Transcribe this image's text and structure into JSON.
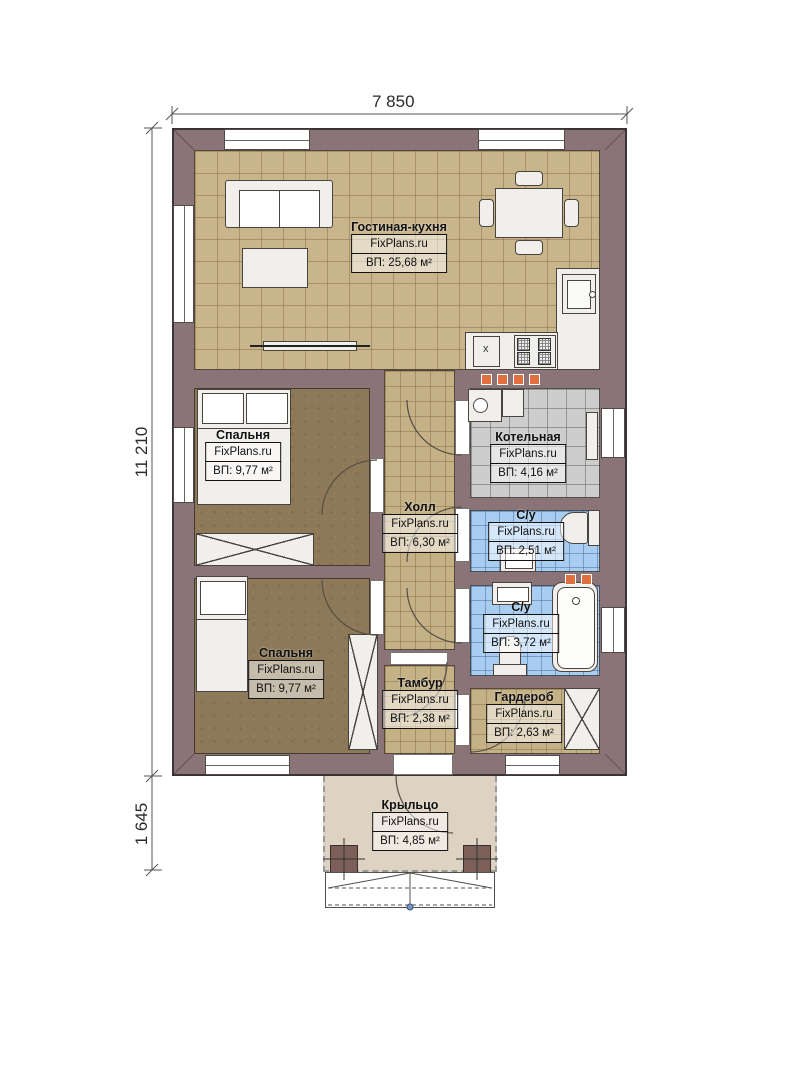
{
  "watermark": "FixPlans.ru",
  "dimensions": {
    "width_top": "7 850",
    "height_left": "11 210",
    "porch_height": "1 645"
  },
  "rooms": {
    "living": {
      "name": "Гостиная-кухня",
      "area": "ВП: 25,68 м²"
    },
    "bedroom1": {
      "name": "Спальня",
      "area": "ВП: 9,77 м²"
    },
    "boiler": {
      "name": "Котельная",
      "area": "ВП: 4,16 м²"
    },
    "hall": {
      "name": "Холл",
      "area": "ВП: 6,30 м²"
    },
    "wc1": {
      "name": "С/у",
      "area": "ВП: 2,51 м²"
    },
    "wc2": {
      "name": "С/у",
      "area": "ВП: 3,72 м²"
    },
    "bedroom2": {
      "name": "Спальня",
      "area": "ВП: 9,77 м²"
    },
    "tambur": {
      "name": "Тамбур",
      "area": "ВП: 2,38 м²"
    },
    "wardrobe": {
      "name": "Гардероб",
      "area": "ВП: 2,63 м²"
    },
    "porch": {
      "name": "Крыльцо",
      "area": "ВП: 4,85 м²"
    }
  },
  "kitchen": {
    "appliance_label": "x"
  },
  "colors": {
    "wall": "#8a7478",
    "floor_tan": "#c9b58c",
    "floor_brown": "#8d7857",
    "floor_gray": "#cdcdcd",
    "floor_blue": "#a9cdf0",
    "porch": "#ded3c2",
    "vent": "#e0703f"
  }
}
